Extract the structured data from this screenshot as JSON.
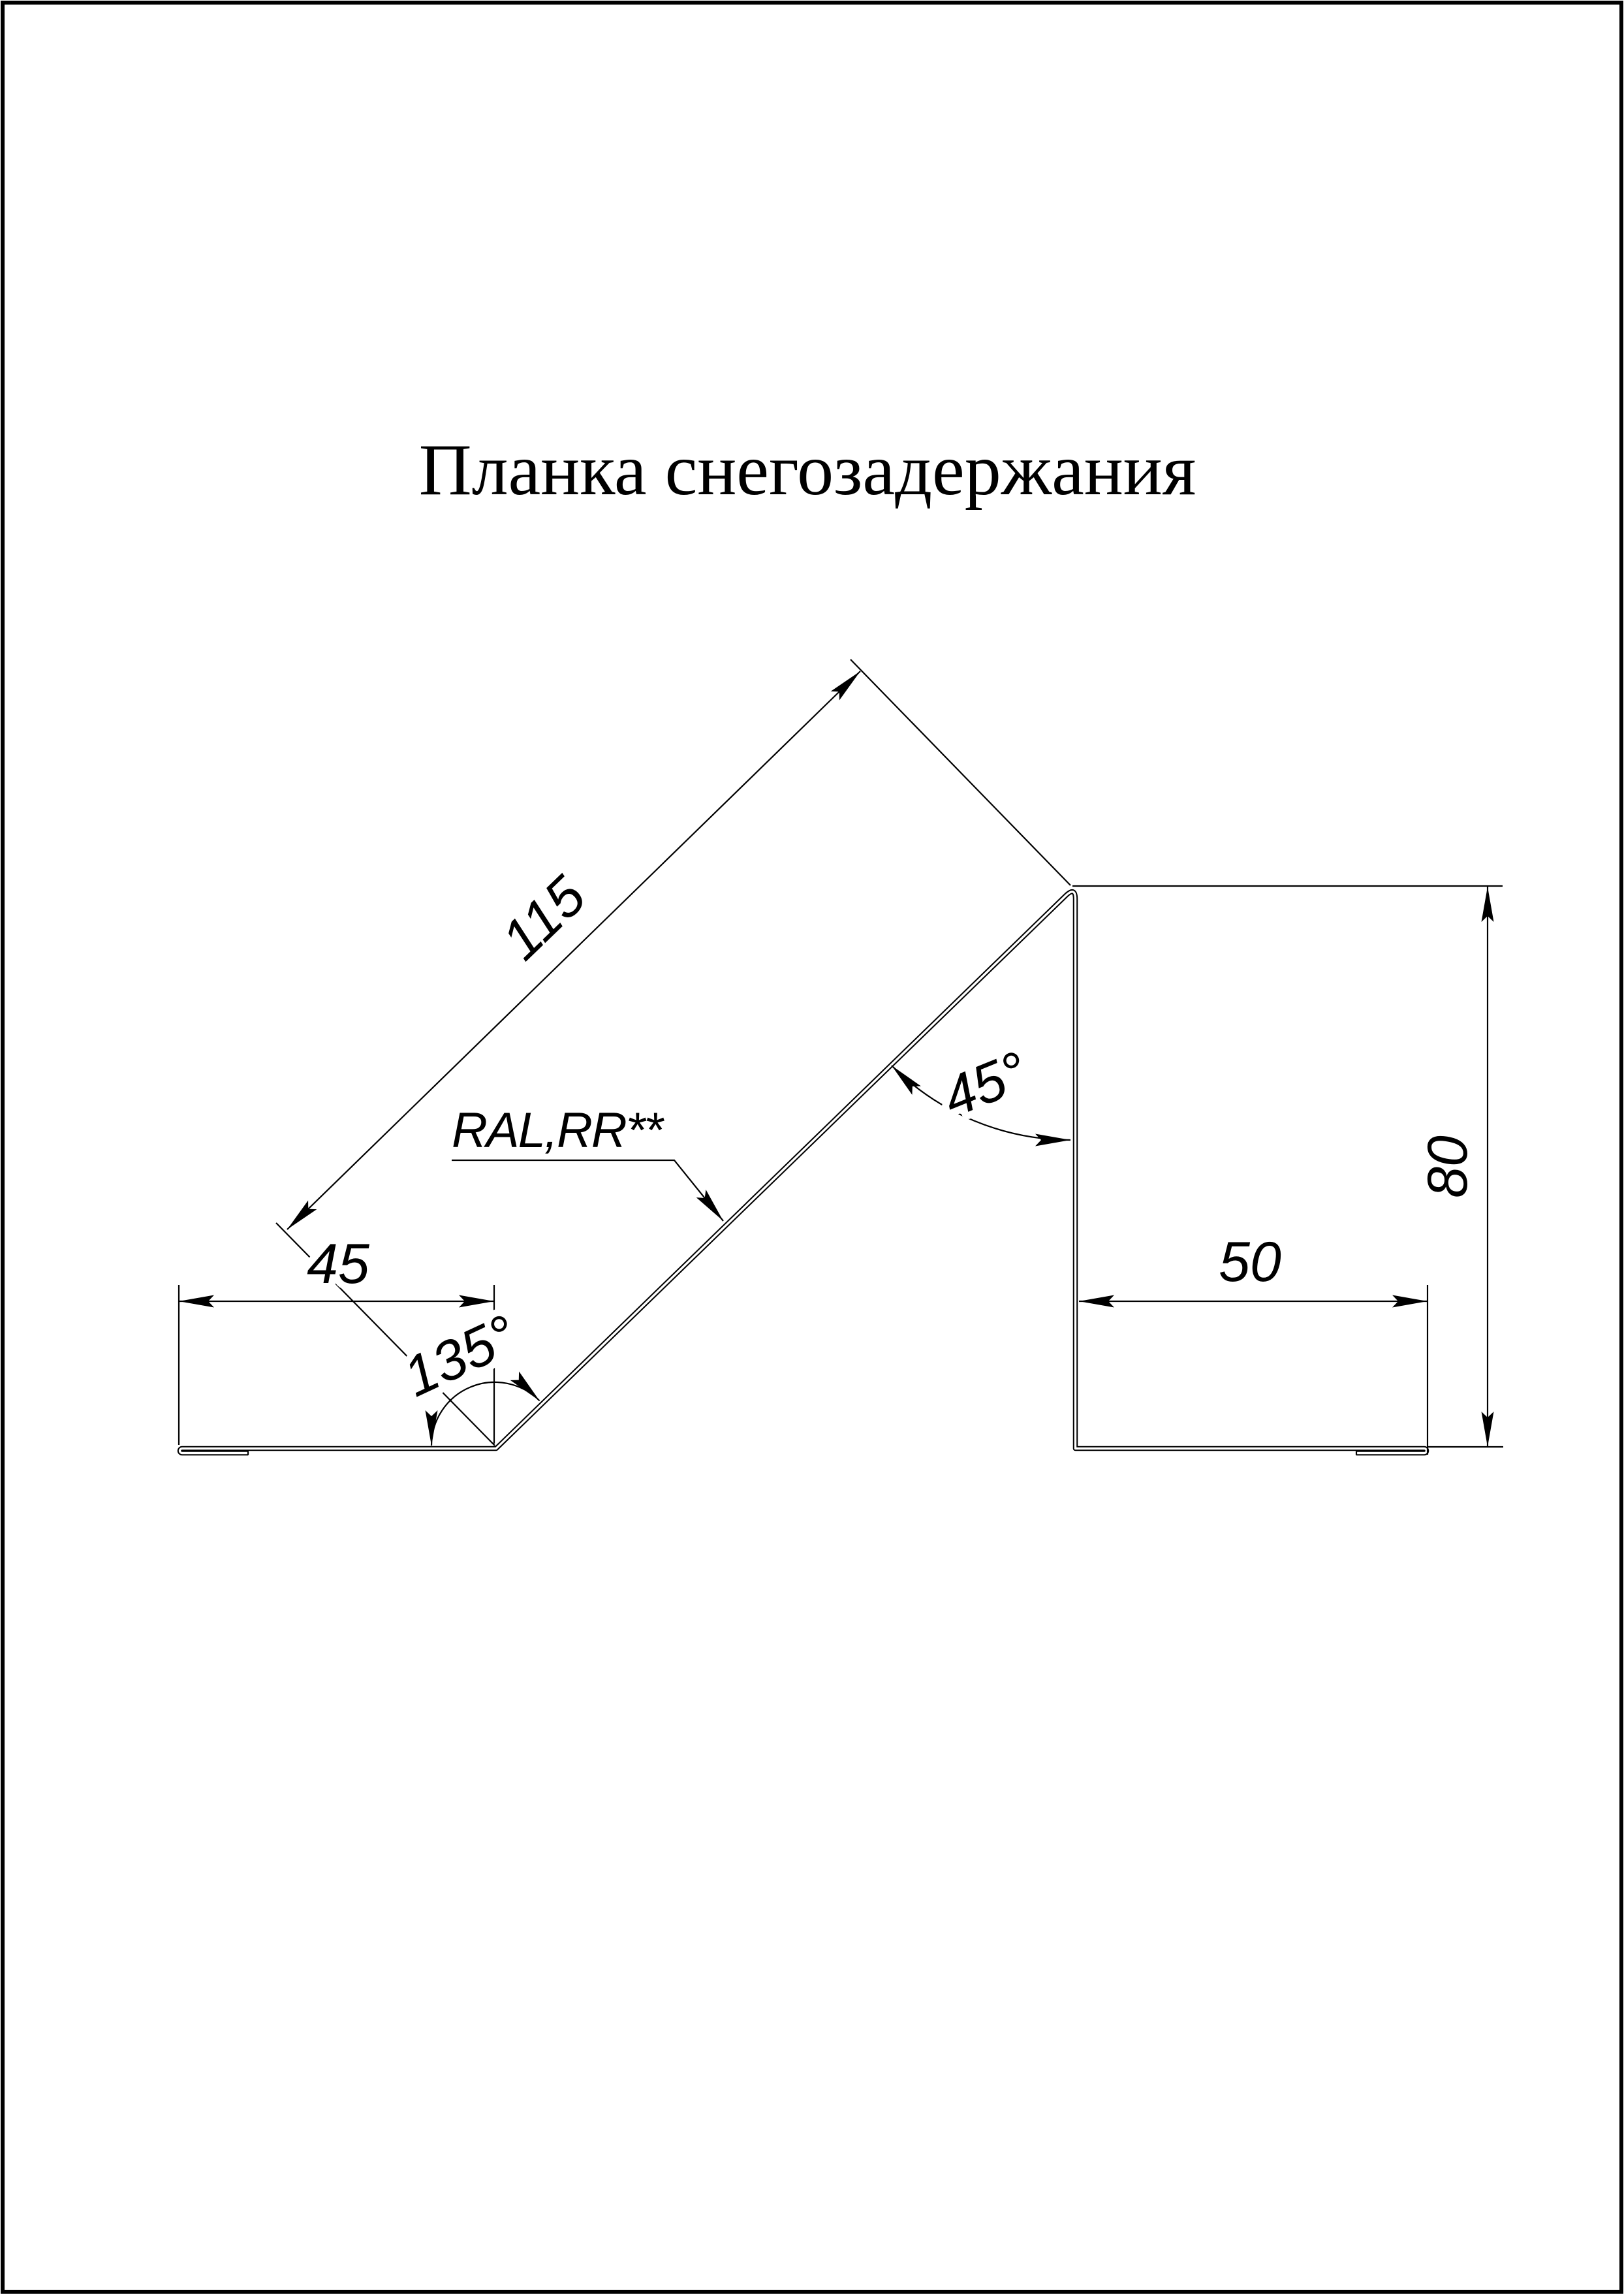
{
  "page": {
    "title": "Планка снегозадержания"
  },
  "drawing": {
    "kind": "sheet-metal-profile-cross-section",
    "labels": {
      "diagonal_length": "115",
      "left_flange_width": "45",
      "left_bend_angle": "135°",
      "peak_bend_angle": "45°",
      "right_flange_width": "50",
      "web_height": "80",
      "coating": "RAL,RR**"
    },
    "colors": {
      "line": "#000000",
      "background": "#ffffff"
    }
  }
}
